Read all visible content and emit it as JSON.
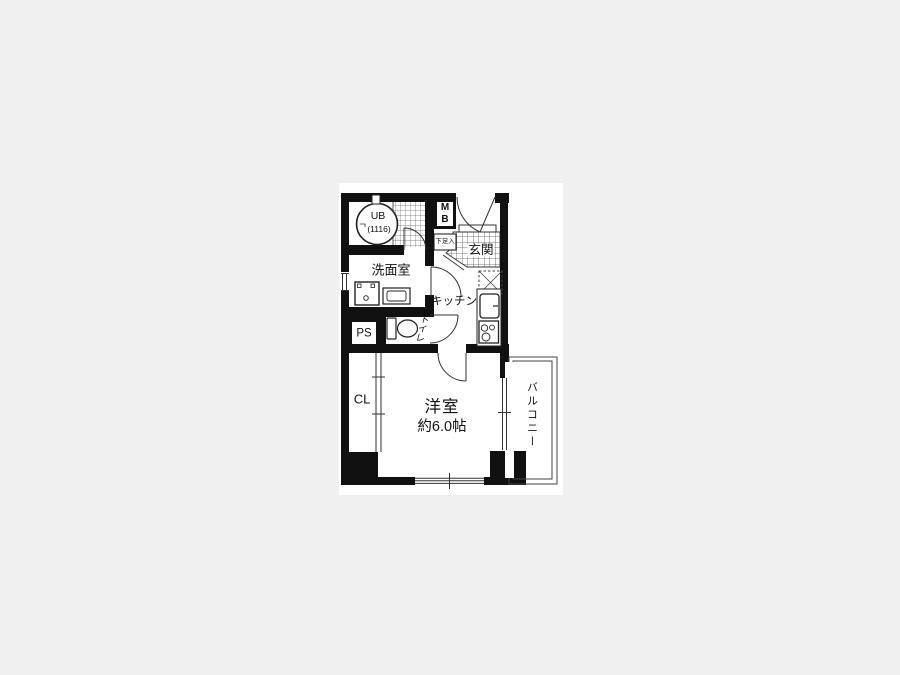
{
  "page": {
    "background": "#f0f0f0",
    "paper": "#ffffff",
    "wall_color": "#111111",
    "line_color": "#333333"
  },
  "floor_plan": {
    "unit_bath": {
      "label": "UB",
      "size": "(1116)"
    },
    "meter_box": {
      "line1": "M",
      "line2": "B"
    },
    "entrance": {
      "label": "玄関"
    },
    "shoe_storage": {
      "label": "下足入"
    },
    "washroom": {
      "label": "洗面室"
    },
    "kitchen": {
      "label": "キッチン"
    },
    "toilet": {
      "label": "トイレ"
    },
    "pipe_space": {
      "label": "PS"
    },
    "closet": {
      "label": "CL"
    },
    "main_room": {
      "label": "洋室",
      "size": "約6.0帖"
    },
    "balcony": {
      "label": "バルコニー"
    }
  }
}
